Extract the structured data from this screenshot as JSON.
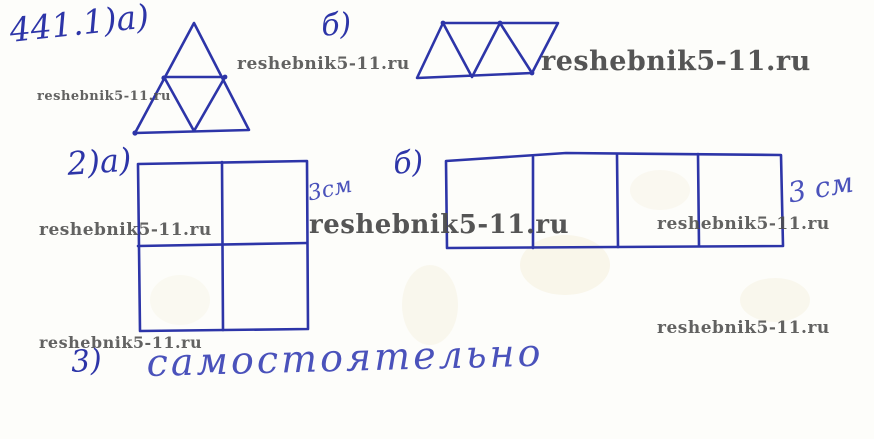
{
  "page": {
    "background": "#fdfdfa",
    "ink_color": "#2d35a8",
    "accent_ink_color": "#4a52bb",
    "watermark_color": "#4d4d4d"
  },
  "watermark": {
    "text": "reshebnik5-11.ru"
  },
  "labels": {
    "problem_number": "441.1)а)",
    "part_b_triangles": "б)",
    "part_2a": "2)а)",
    "square_side_label": "3см",
    "part_b_rect": "б)",
    "rect_side_label": "3 см",
    "part_3": "3)",
    "part_3_answer": "самостоятельно"
  },
  "figures": [
    {
      "name": "triangle-divided-into-4",
      "description": "triangle split by midlines into 4 small triangles"
    },
    {
      "name": "triangle-strip-of-4",
      "description": "parallelogram strip of 4 alternating up/down triangles"
    },
    {
      "name": "square-2x2",
      "description": "square divided into 4 equal squares, side labeled 3 cm"
    },
    {
      "name": "rectangle-1x4",
      "description": "rectangle divided into 4 equal squares, side labeled 3 cm"
    }
  ]
}
